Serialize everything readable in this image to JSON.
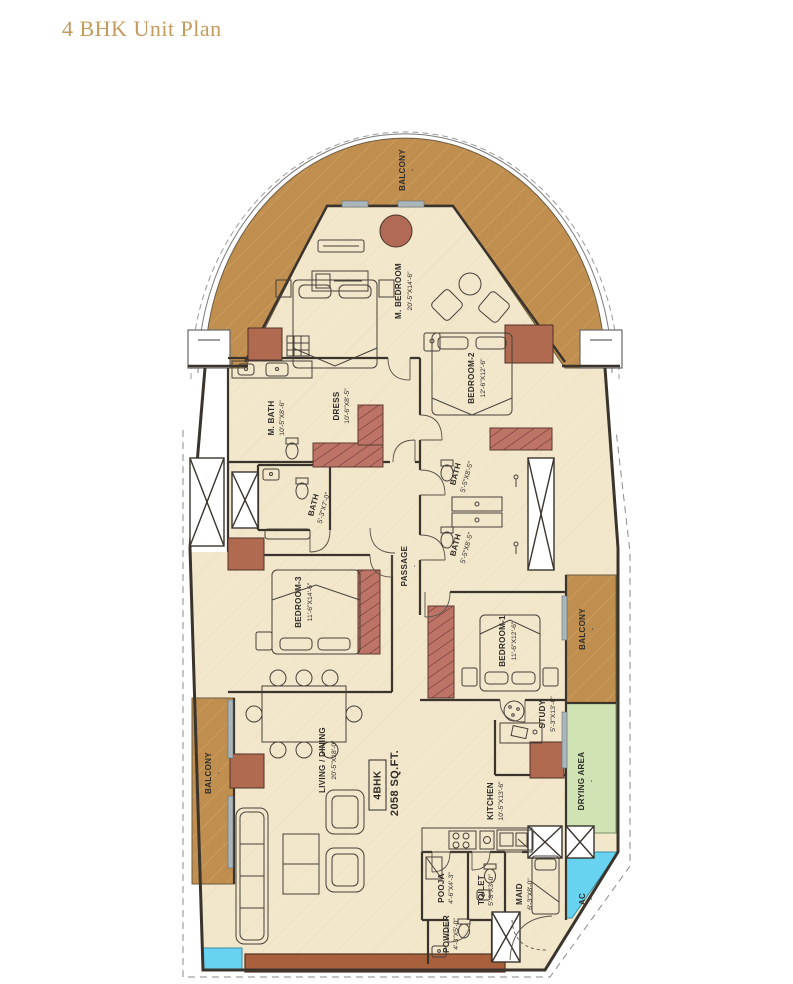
{
  "page": {
    "title": "4 BHK Unit Plan"
  },
  "unit": {
    "type": "4BHK",
    "area": "2058 SQ.FT."
  },
  "rooms": {
    "balcony_top": {
      "label": "BALCONY",
      "dims": "-"
    },
    "m_bedroom": {
      "label": "M. BEDROOM",
      "dims": "20'-5\"X14'-6\""
    },
    "bedroom2": {
      "label": "BEDROOM-2",
      "dims": "12'-6\"X12'-6\""
    },
    "m_bath": {
      "label": "M. BATH",
      "dims": "10'-5\"X8'-6\""
    },
    "dress": {
      "label": "DRESS",
      "dims": "10'-6\"X8'-5\""
    },
    "bath_left": {
      "label": "BATH",
      "dims": "5'-3\"X7'-0\""
    },
    "bath_up": {
      "label": "BATH",
      "dims": "5'-5\"X8'-5\""
    },
    "bath_low": {
      "label": "BATH",
      "dims": "5'-5\"X8'-5\""
    },
    "passage": {
      "label": "PASSAGE",
      "dims": "-"
    },
    "bedroom3": {
      "label": "BEDROOM-3",
      "dims": "11'-6\"X14'-6\""
    },
    "bedroom1": {
      "label": "BEDROOM-1",
      "dims": "11'-6\"X12'-6\""
    },
    "balcony_right": {
      "label": "BALCONY",
      "dims": "-"
    },
    "drying": {
      "label": "DRYING AREA",
      "dims": "-"
    },
    "study": {
      "label": "STUDY",
      "dims": "5'-3\"X13'-6\""
    },
    "kitchen": {
      "label": "KITCHEN",
      "dims": "10'-5\"X13'-6\""
    },
    "living": {
      "label": "LIVING / DINING",
      "dims": "20'-5\"X18'-0\""
    },
    "pooja": {
      "label": "POOJA",
      "dims": "4'-6\"X4'-3\""
    },
    "toilet": {
      "label": "TOILET",
      "dims": "5'-3\"X3'-0\""
    },
    "maid": {
      "label": "MAID",
      "dims": "6'-3\"X8'-0\""
    },
    "powder": {
      "label": "POWDER",
      "dims": "4'-3\"X5'-0\""
    },
    "ac": {
      "label": "AC",
      "dims": "-"
    },
    "balcony_left": {
      "label": "BALCONY",
      "dims": "-"
    }
  },
  "colors": {
    "floor": "#f2e6cb",
    "balcony": "#c08f4f",
    "wardrobe": "#bd7467",
    "cabinet": "#b06a50",
    "drying_area": "#cfe3b4",
    "ac_shaft": "#67d3f0",
    "wall": "#3a342c",
    "title": "#c49a5d"
  }
}
